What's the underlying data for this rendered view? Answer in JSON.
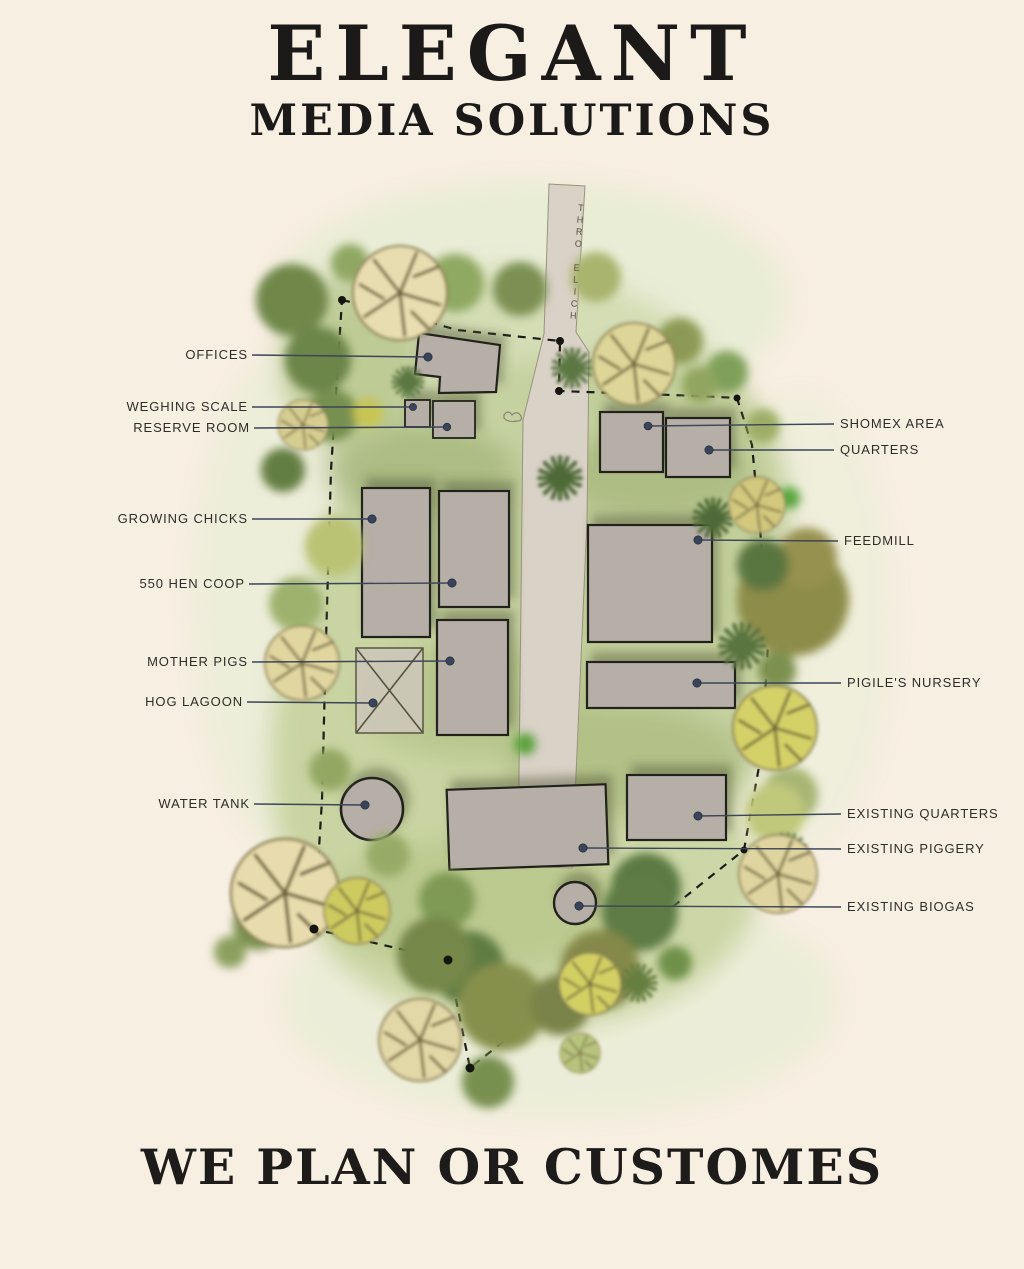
{
  "header": {
    "title": "ELEGANT",
    "subtitle": "MEDIA SOLUTIONS"
  },
  "footer": {
    "tagline": "WE PLAN OR CUSTOMES"
  },
  "plan": {
    "road_text": "THRO ELICH",
    "labels": {
      "offices": "OFFICES",
      "weighing_scale": "WEGHING SCALE",
      "reserve_room": "RESERVE ROOM",
      "growing_chicks": "GROWING CHICKS",
      "hen_coop": "550 HEN COOP",
      "mother_pigs": "MOTHER PIGS",
      "hog_lagoon": "HOG LAGOON",
      "water_tank": "WATER TANK",
      "shomex_area": "SHOMEX AREA",
      "quarters": "QUARTERS",
      "feedmill": "FEEDMILL",
      "pigiles_nursery": "PIGILE'S NURSERY",
      "existing_quarters": "EXISTING QUARTERS",
      "existing_piggery": "EXISTING PIGGERY",
      "existing_biogas": "EXISTING BIOGAS"
    },
    "colors": {
      "background": "#f8efe3",
      "building": "#b6afa7",
      "building_outline": "#22221d",
      "leader_line": "#3d4557",
      "boundary": "#1c1c17",
      "road": "#d9d2c7"
    }
  }
}
